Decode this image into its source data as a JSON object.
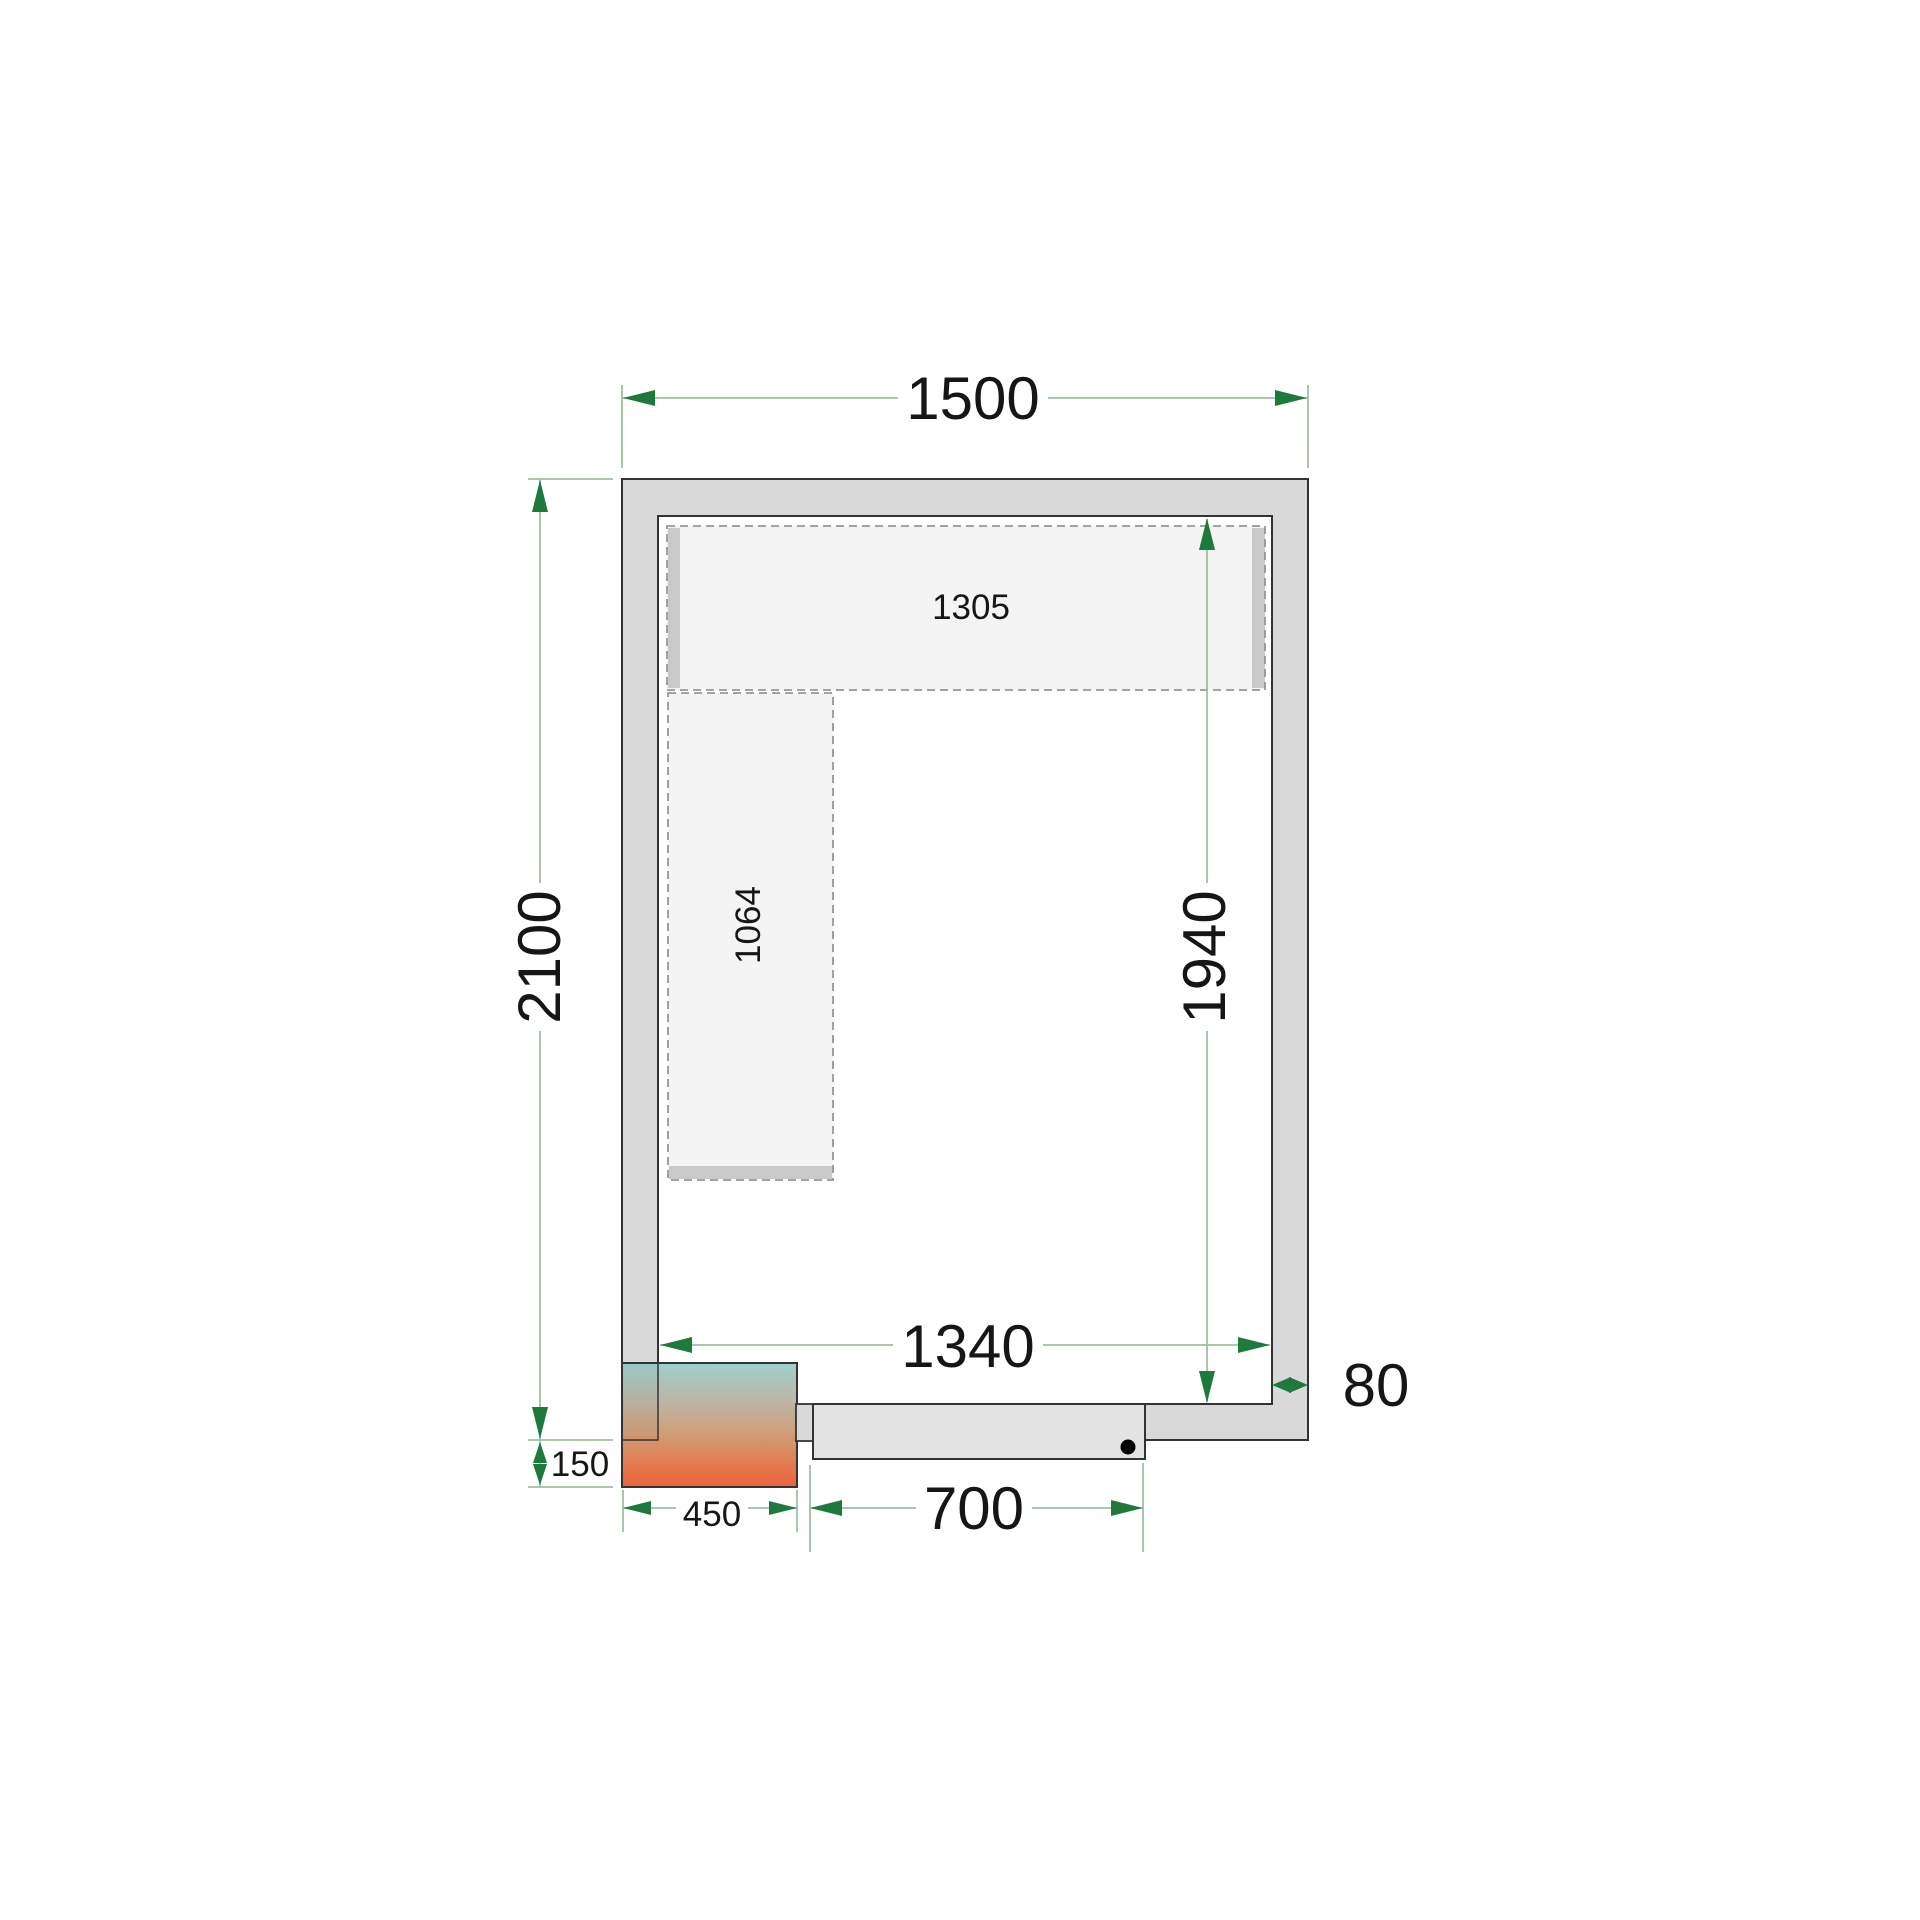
{
  "drawing": {
    "type": "cold-room-floor-plan",
    "dims": {
      "outer_width": "1500",
      "outer_depth": "2100",
      "top_shelf_length": "1305",
      "left_shelf_length": "1064",
      "inner_depth": "1940",
      "inner_width": "1340",
      "wall_thickness": "80",
      "unit_offset": "150",
      "unit_width": "450",
      "door_width": "700"
    },
    "colors": {
      "wall_fill": "#d9d9d9",
      "outline": "#333333",
      "dim_line": "#9dc1a3",
      "dim_arrow": "#1e7a3c",
      "shelf_fill": "#f4f4f4",
      "shelf_dash": "#969696",
      "rail_fill": "#c9c9c9",
      "door_fill": "#e3e3e3",
      "jamb_fill": "#d9d9d9",
      "unit_gradient_top": "#8dc8c3",
      "unit_gradient_mid": "#c68f63",
      "unit_gradient_bottom": "#e8471b",
      "handle_dot": "#000000"
    }
  }
}
